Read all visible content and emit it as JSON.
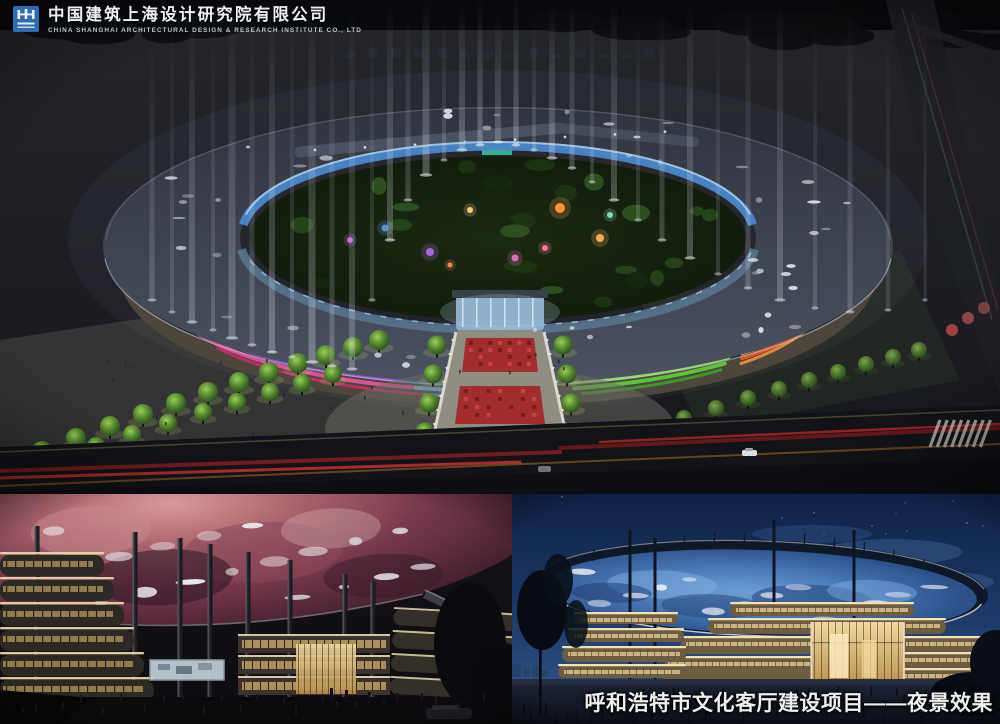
{
  "header": {
    "company_zh": "中国建筑上海设计研究院有限公司",
    "company_en": "CHINA SHANGHAI ARCHITECTURAL DESIGN & RESEARCH INSTITUTE CO., LTD"
  },
  "caption": {
    "text": "呼和浩特市文化客厅建设项目——夜景效果"
  },
  "colors": {
    "logo_blue": "#2e6cb2",
    "company_text": "#eef0f5",
    "caption_text": "#efefef",
    "facade_magenta": "#e0559c",
    "facade_pink_deep": "#c22e66",
    "facade_purple": "#9a50d0",
    "facade_blue": "#5a8fdf",
    "facade_green": "#5ec93a",
    "facade_green_light": "#8ae05c",
    "facade_orange": "#f0913a",
    "facade_red": "#e8542a",
    "facade_yellow": "#eec23e",
    "inner_ring_blue": "#4a86c8",
    "beam_white": "#e9edf5",
    "carpet_red": "#a32626",
    "tree_green": "#6fae3c",
    "nebula_pink": "#a85f6e",
    "starry_blue": "#4a7ab8",
    "dusk_sky_top": "#0e2246",
    "dusk_sky_bottom": "#31547e",
    "warm_band": "#e3c98e"
  }
}
